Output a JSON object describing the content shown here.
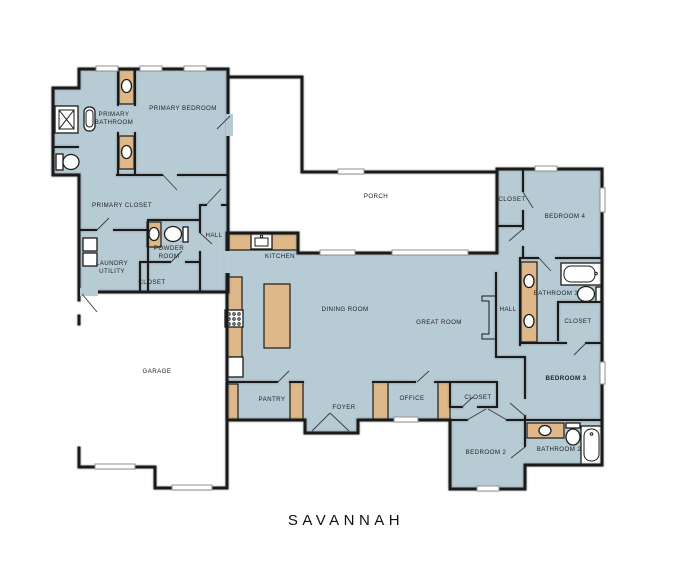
{
  "plan": {
    "title": "SAVANNAH",
    "colors": {
      "background": "#ffffff",
      "floor": "#b7cbd5",
      "cabinet": "#deb888",
      "wall": "#1a1a1a",
      "window": "#909090"
    },
    "rooms": {
      "primary_bathroom": {
        "line1": "PRIMARY",
        "line2": "BATHROOM"
      },
      "primary_bedroom": {
        "label": "PRIMARY BEDROOM"
      },
      "primary_closet": {
        "label": "PRIMARY CLOSET"
      },
      "powder_room": {
        "line1": "POWDER",
        "line2": "ROOM"
      },
      "laundry_utility": {
        "line1": "LAUNDRY",
        "line2": "UTILITY"
      },
      "closet_laundry": {
        "label": "CLOSET"
      },
      "hall_left": {
        "label": "HALL"
      },
      "kitchen": {
        "label": "KITCHEN"
      },
      "porch": {
        "label": "PORCH"
      },
      "garage": {
        "label": "GARAGE"
      },
      "dining_room": {
        "label": "DINING ROOM"
      },
      "great_room": {
        "label": "GREAT ROOM"
      },
      "pantry": {
        "label": "PANTRY"
      },
      "foyer": {
        "label": "FOYER"
      },
      "office": {
        "label": "OFFICE"
      },
      "closet_office": {
        "label": "CLOSET"
      },
      "hall_right": {
        "label": "HALL"
      },
      "closet_bedroom4": {
        "label": "CLOSET"
      },
      "bedroom4": {
        "label": "BEDROOM 4"
      },
      "bathroom3": {
        "label": "BATHROOM 3"
      },
      "closet_hall": {
        "label": "CLOSET"
      },
      "bedroom3": {
        "label": "BEDROOM 3"
      },
      "bedroom2": {
        "label": "BEDROOM 2"
      },
      "bathroom2": {
        "label": "BATHROOM 2"
      }
    },
    "fixtures": {
      "shower": "shower-icon",
      "bathtub": "bathtub-icon",
      "toilet": "toilet-icon",
      "sink": "sink-icon",
      "washer_dryer": "washer-dryer-icon",
      "cooktop": "cooktop-icon",
      "fireplace": "fireplace-icon",
      "kitchen_island": "kitchen-island-icon"
    }
  }
}
